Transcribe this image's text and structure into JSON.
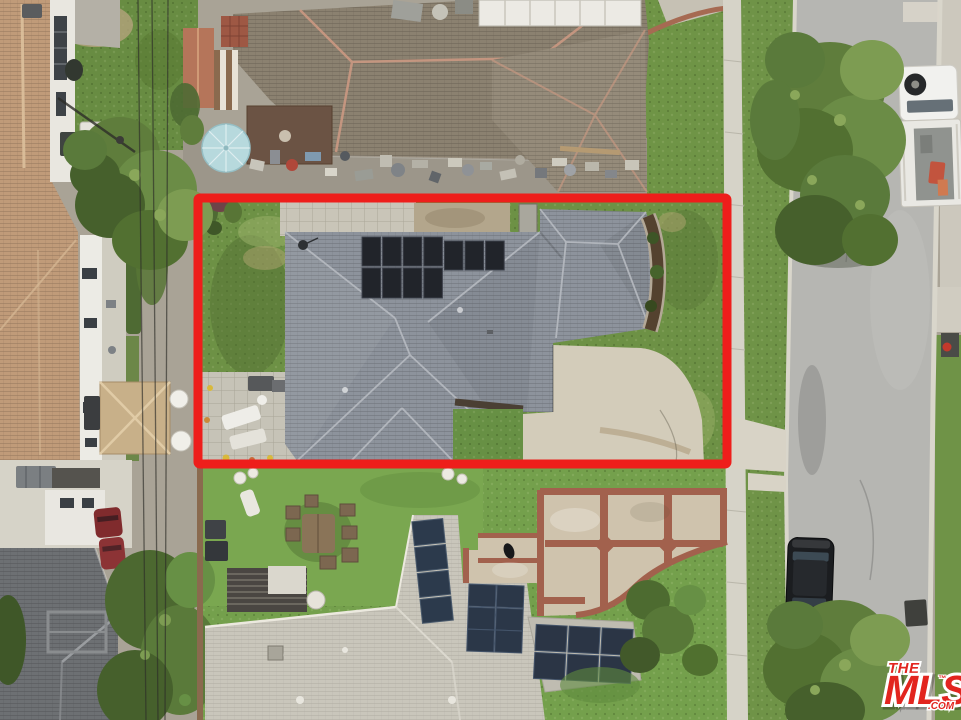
{
  "image": {
    "kind": "aerial-drone-photograph",
    "subject": "top-down view of a single-story house with rooftop solar panels, lot outlined in red",
    "width_px": 961,
    "height_px": 720
  },
  "watermark": {
    "the": "THE",
    "mls": "MLS",
    "tm": "™",
    "com": ".COM"
  },
  "colors": {
    "boundary_red": "#ee1e1b",
    "logo_red": "#e2251f",
    "logo_outline": "#ffffff",
    "street": "#b6b6b2",
    "sidewalk": "#d6d3c8",
    "lawn": "#6d9145",
    "bright_lawn": "#7aa750",
    "subject_roof": "#8d939c",
    "solar_black": "#21242a",
    "solar_blue": "#2c3a4c",
    "neighbor_roof_top": "#8b8170",
    "neighbor_roof_left": "#c09b79",
    "neighbor_roof_bottom": "#c9c6bb",
    "driveway": "#d3ccba",
    "walkway_brick": "#a2614d",
    "walkway_tan": "#cfc3ad",
    "umbrella": "#b7d9dd",
    "truck_white": "#f1f1ee",
    "car_black": "#1b1d20",
    "car_white": "#e9e9e6",
    "car_red": "#802b2d",
    "hydrant_red": "#c2392c"
  },
  "scene_objects": [
    "subject house with rooftop solar array",
    "red property boundary outline",
    "concrete driveway",
    "backyard paver patio with loungers",
    "front and side lawns",
    "neighboring houses with shingle roofs",
    "cluttered neighbor backyard with light-blue umbrella",
    "vertical street with parked black car and white utility truck",
    "street trees overhanging parked cars",
    "sidewalk and grass parkway",
    "power lines",
    "brick-bordered front walkway of lower neighbor",
    "THE MLS .COM watermark"
  ]
}
